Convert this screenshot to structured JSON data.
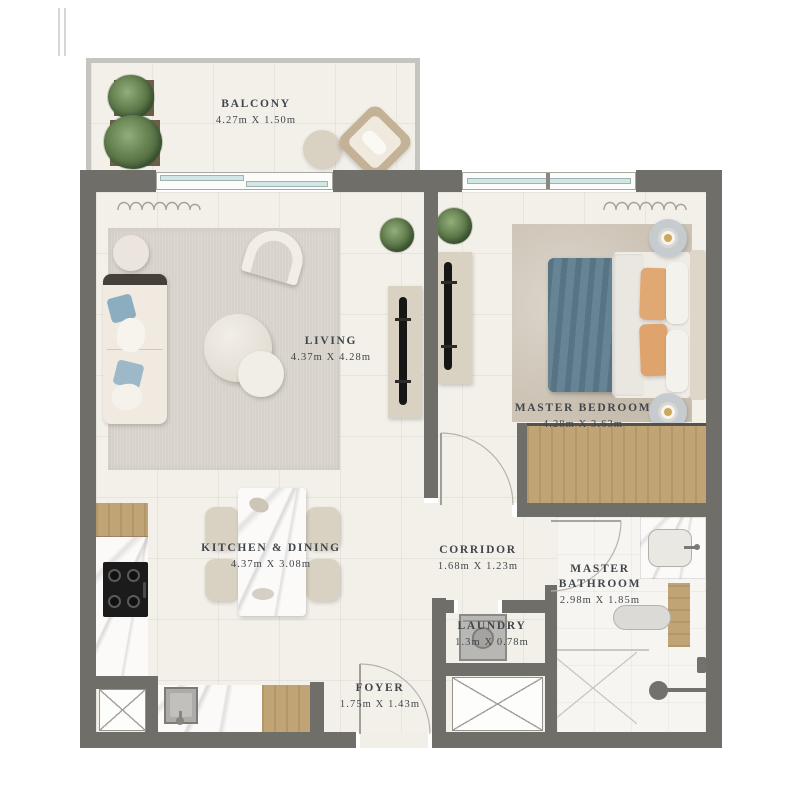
{
  "plan": {
    "type": "apartment-floor-plan",
    "rooms": [
      {
        "id": "balcony",
        "name": "BALCONY",
        "dims": "4.27m X 1.50m"
      },
      {
        "id": "living",
        "name": "LIVING",
        "dims": "4.37m X 4.28m"
      },
      {
        "id": "master-bedroom",
        "name": "MASTER BEDROOM",
        "dims": "4.28m X 3.63m"
      },
      {
        "id": "kitchen-dining",
        "name": "KITCHEN & DINING",
        "dims": "4.37m X 3.08m"
      },
      {
        "id": "corridor",
        "name": "CORRIDOR",
        "dims": "1.68m X 1.23m"
      },
      {
        "id": "master-bathroom",
        "name": "MASTER BATHROOM",
        "dims": "2.98m X 1.85m"
      },
      {
        "id": "laundry",
        "name": "LAUNDRY",
        "dims": "1.3m X 0.78m"
      },
      {
        "id": "foyer",
        "name": "FOYER",
        "dims": "1.75m X 1.43m"
      }
    ],
    "colors": {
      "wall": "#706e69",
      "floor": "#f3f0ea",
      "wood": "#c0a475",
      "window_glass": "#d2e6e5",
      "bed_blanket": "#5e7d8f",
      "pillow_accent": "#e0a873",
      "sofa_pillow": "#8cadc0",
      "plant": "#637f4e",
      "label_text": "#41464b"
    }
  }
}
